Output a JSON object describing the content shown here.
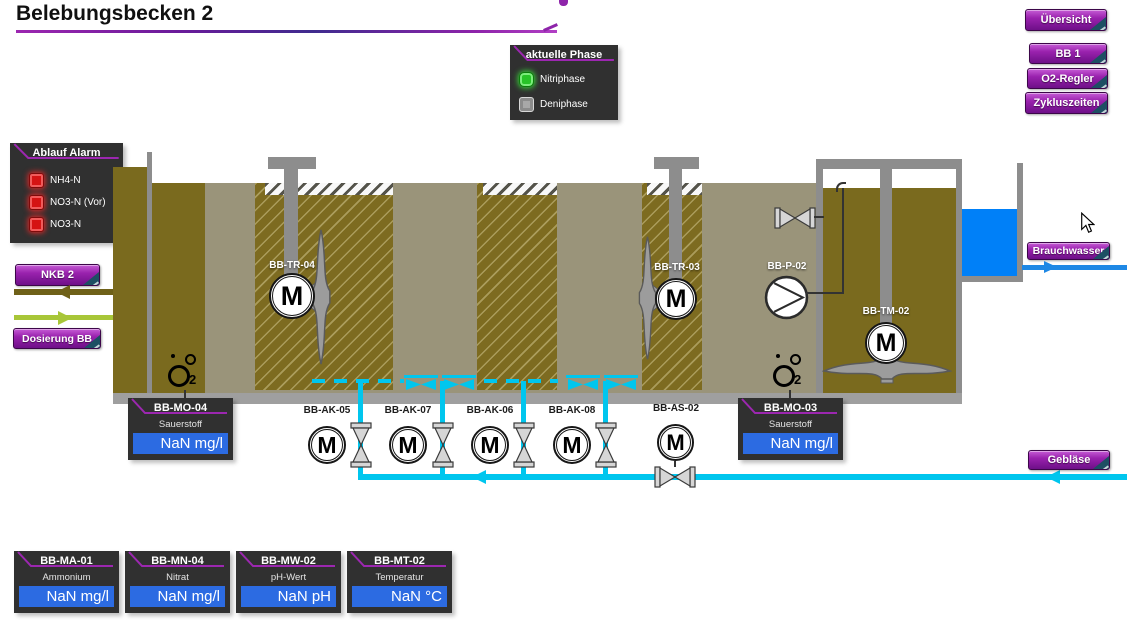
{
  "page": {
    "title": "Belebungsbecken 2"
  },
  "nav_buttons": [
    {
      "label": "Übersicht"
    },
    {
      "label": "BB 1"
    },
    {
      "label": "O2-Regler"
    },
    {
      "label": "Zykluszeiten"
    }
  ],
  "phase_panel": {
    "title": "aktuelle Phase",
    "items": [
      {
        "label": "Nitriphase",
        "state": "active"
      },
      {
        "label": "Deniphase",
        "state": "inactive"
      }
    ]
  },
  "alarm_panel": {
    "title": "Ablauf Alarm",
    "items": [
      {
        "label": "NH4-N"
      },
      {
        "label": "NO3-N (Vor)"
      },
      {
        "label": "NO3-N"
      }
    ]
  },
  "flow_buttons": {
    "nkb2": "NKB 2",
    "dosierung_bb": "Dosierung BB",
    "brauchwasser": "Brauchwasser",
    "geblaese": "Gebläse"
  },
  "equipment": {
    "mixer_tr04": "BB-TR-04",
    "mixer_tr03": "BB-TR-03",
    "pump_p02": "BB-P-02",
    "mixer_tm02": "BB-TM-02",
    "valve_ak05": "BB-AK-05",
    "valve_ak07": "BB-AK-07",
    "valve_ak06": "BB-AK-06",
    "valve_ak08": "BB-AK-08",
    "valve_as02": "BB-AS-02"
  },
  "measurements": {
    "mo04": {
      "id": "BB-MO-04",
      "label": "Sauerstoff",
      "value": "NaN mg/l"
    },
    "mo03": {
      "id": "BB-MO-03",
      "label": "Sauerstoff",
      "value": "NaN mg/l"
    },
    "ma01": {
      "id": "BB-MA-01",
      "label": "Ammonium",
      "value": "NaN mg/l"
    },
    "mn04": {
      "id": "BB-MN-04",
      "label": "Nitrat",
      "value": "NaN mg/l"
    },
    "mw02": {
      "id": "BB-MW-02",
      "label": "pH-Wert",
      "value": "NaN pH"
    },
    "mt02": {
      "id": "BB-MT-02",
      "label": "Temperatur",
      "value": "NaN °C"
    }
  },
  "symbols": {
    "motor_letter": "M",
    "o2_sub": "2"
  },
  "colors": {
    "accent_purple": "#9c27b0",
    "value_blue": "#2c6be2",
    "pipe_cyan": "#00c6ee",
    "water_blue": "#0080f8",
    "basin_taupe": "#9a947a",
    "sludge_olive": "#7a6a1e",
    "alarm_red": "#d51313",
    "phase_green": "#27c427"
  }
}
